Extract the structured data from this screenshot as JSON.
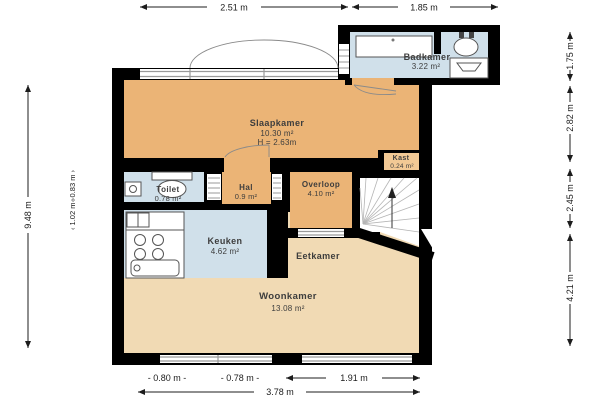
{
  "plan": {
    "rooms": {
      "slaapkamer": {
        "name": "Slaapkamer",
        "area": "10.30 m²",
        "ceiling_height": "H = 2.63m"
      },
      "badkamer": {
        "name": "Badkamer",
        "area": "3.22 m²"
      },
      "kast": {
        "name": "Kast",
        "area": "0.24 m²"
      },
      "overloop": {
        "name": "Overloop",
        "area": "4.10 m²"
      },
      "hal": {
        "name": "Hal",
        "area": "0.9 m²"
      },
      "toilet": {
        "name": "Toilet",
        "area": "0.78 m²"
      },
      "keuken": {
        "name": "Keuken",
        "area": "4.62 m²"
      },
      "eetkamer": {
        "name": "Eetkamer"
      },
      "woonkamer": {
        "name": "Woonkamer",
        "area": "13.08 m²"
      }
    },
    "dimensions": {
      "top": [
        "2.51 m",
        "1.85 m"
      ],
      "left_total": "9.48 m",
      "left_inner": [
        "‹ 0.83 m ›",
        "‹ 1.02 m ›"
      ],
      "right": [
        "1.75 m",
        "2.82 m",
        "2.45 m",
        "4.21 m"
      ],
      "bottom": [
        "- 0.80 m -",
        "- 0.78 m -",
        "1.91 m"
      ],
      "bottom_total": "3.78 m"
    },
    "colors": {
      "walls": "#000000",
      "room_orange": "#ebb476",
      "room_tan": "#f1dab4",
      "room_blue": "#d0e0ea",
      "room_kast": "#f2c995",
      "dim_text": "#1c1c1c",
      "label_text": "#3d3d3d",
      "window_line": "#9a9a9a",
      "fixture_line": "#555555"
    }
  }
}
